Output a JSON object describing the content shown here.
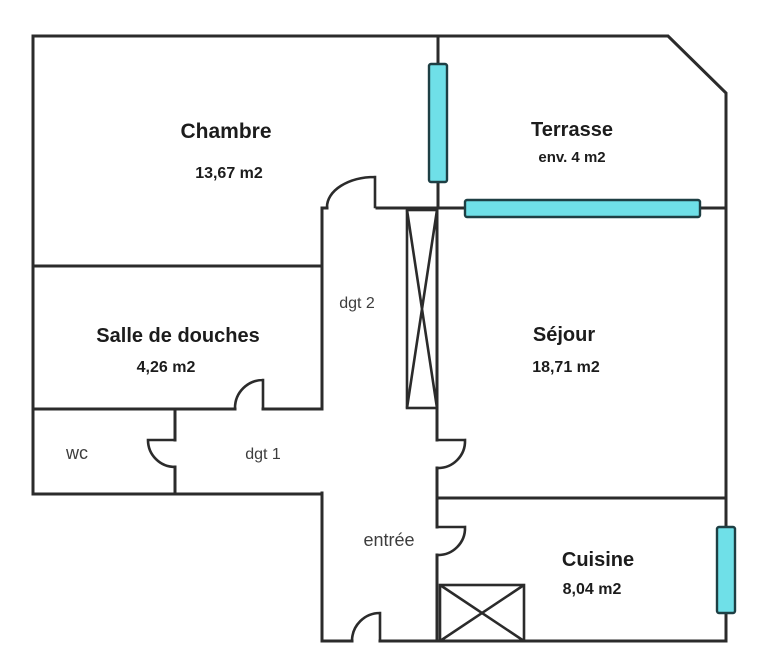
{
  "plan": {
    "type": "apartment-floor-plan",
    "rooms": [
      {
        "id": "chambre",
        "label": "Chambre",
        "area": "13,67 m2"
      },
      {
        "id": "terrasse",
        "label": "Terrasse",
        "area": "env. 4 m2"
      },
      {
        "id": "salle_de_douches",
        "label": "Salle de douches",
        "area": "4,26 m2"
      },
      {
        "id": "sejour",
        "label": "Séjour",
        "area": "18,71 m2"
      },
      {
        "id": "cuisine",
        "label": "Cuisine",
        "area": "8,04 m2"
      },
      {
        "id": "wc",
        "label": "wc"
      },
      {
        "id": "dgt1",
        "label": "dgt 1"
      },
      {
        "id": "dgt2",
        "label": "dgt 2"
      },
      {
        "id": "entree",
        "label": "entrée"
      }
    ],
    "colors": {
      "background": "#ffffff",
      "wall": "#2b2b2b",
      "window_fill": "#6fe0e8",
      "window_stroke": "#1e3f44",
      "text_primary": "#1c1c1c",
      "text_secondary": "#3d3d3d"
    }
  }
}
